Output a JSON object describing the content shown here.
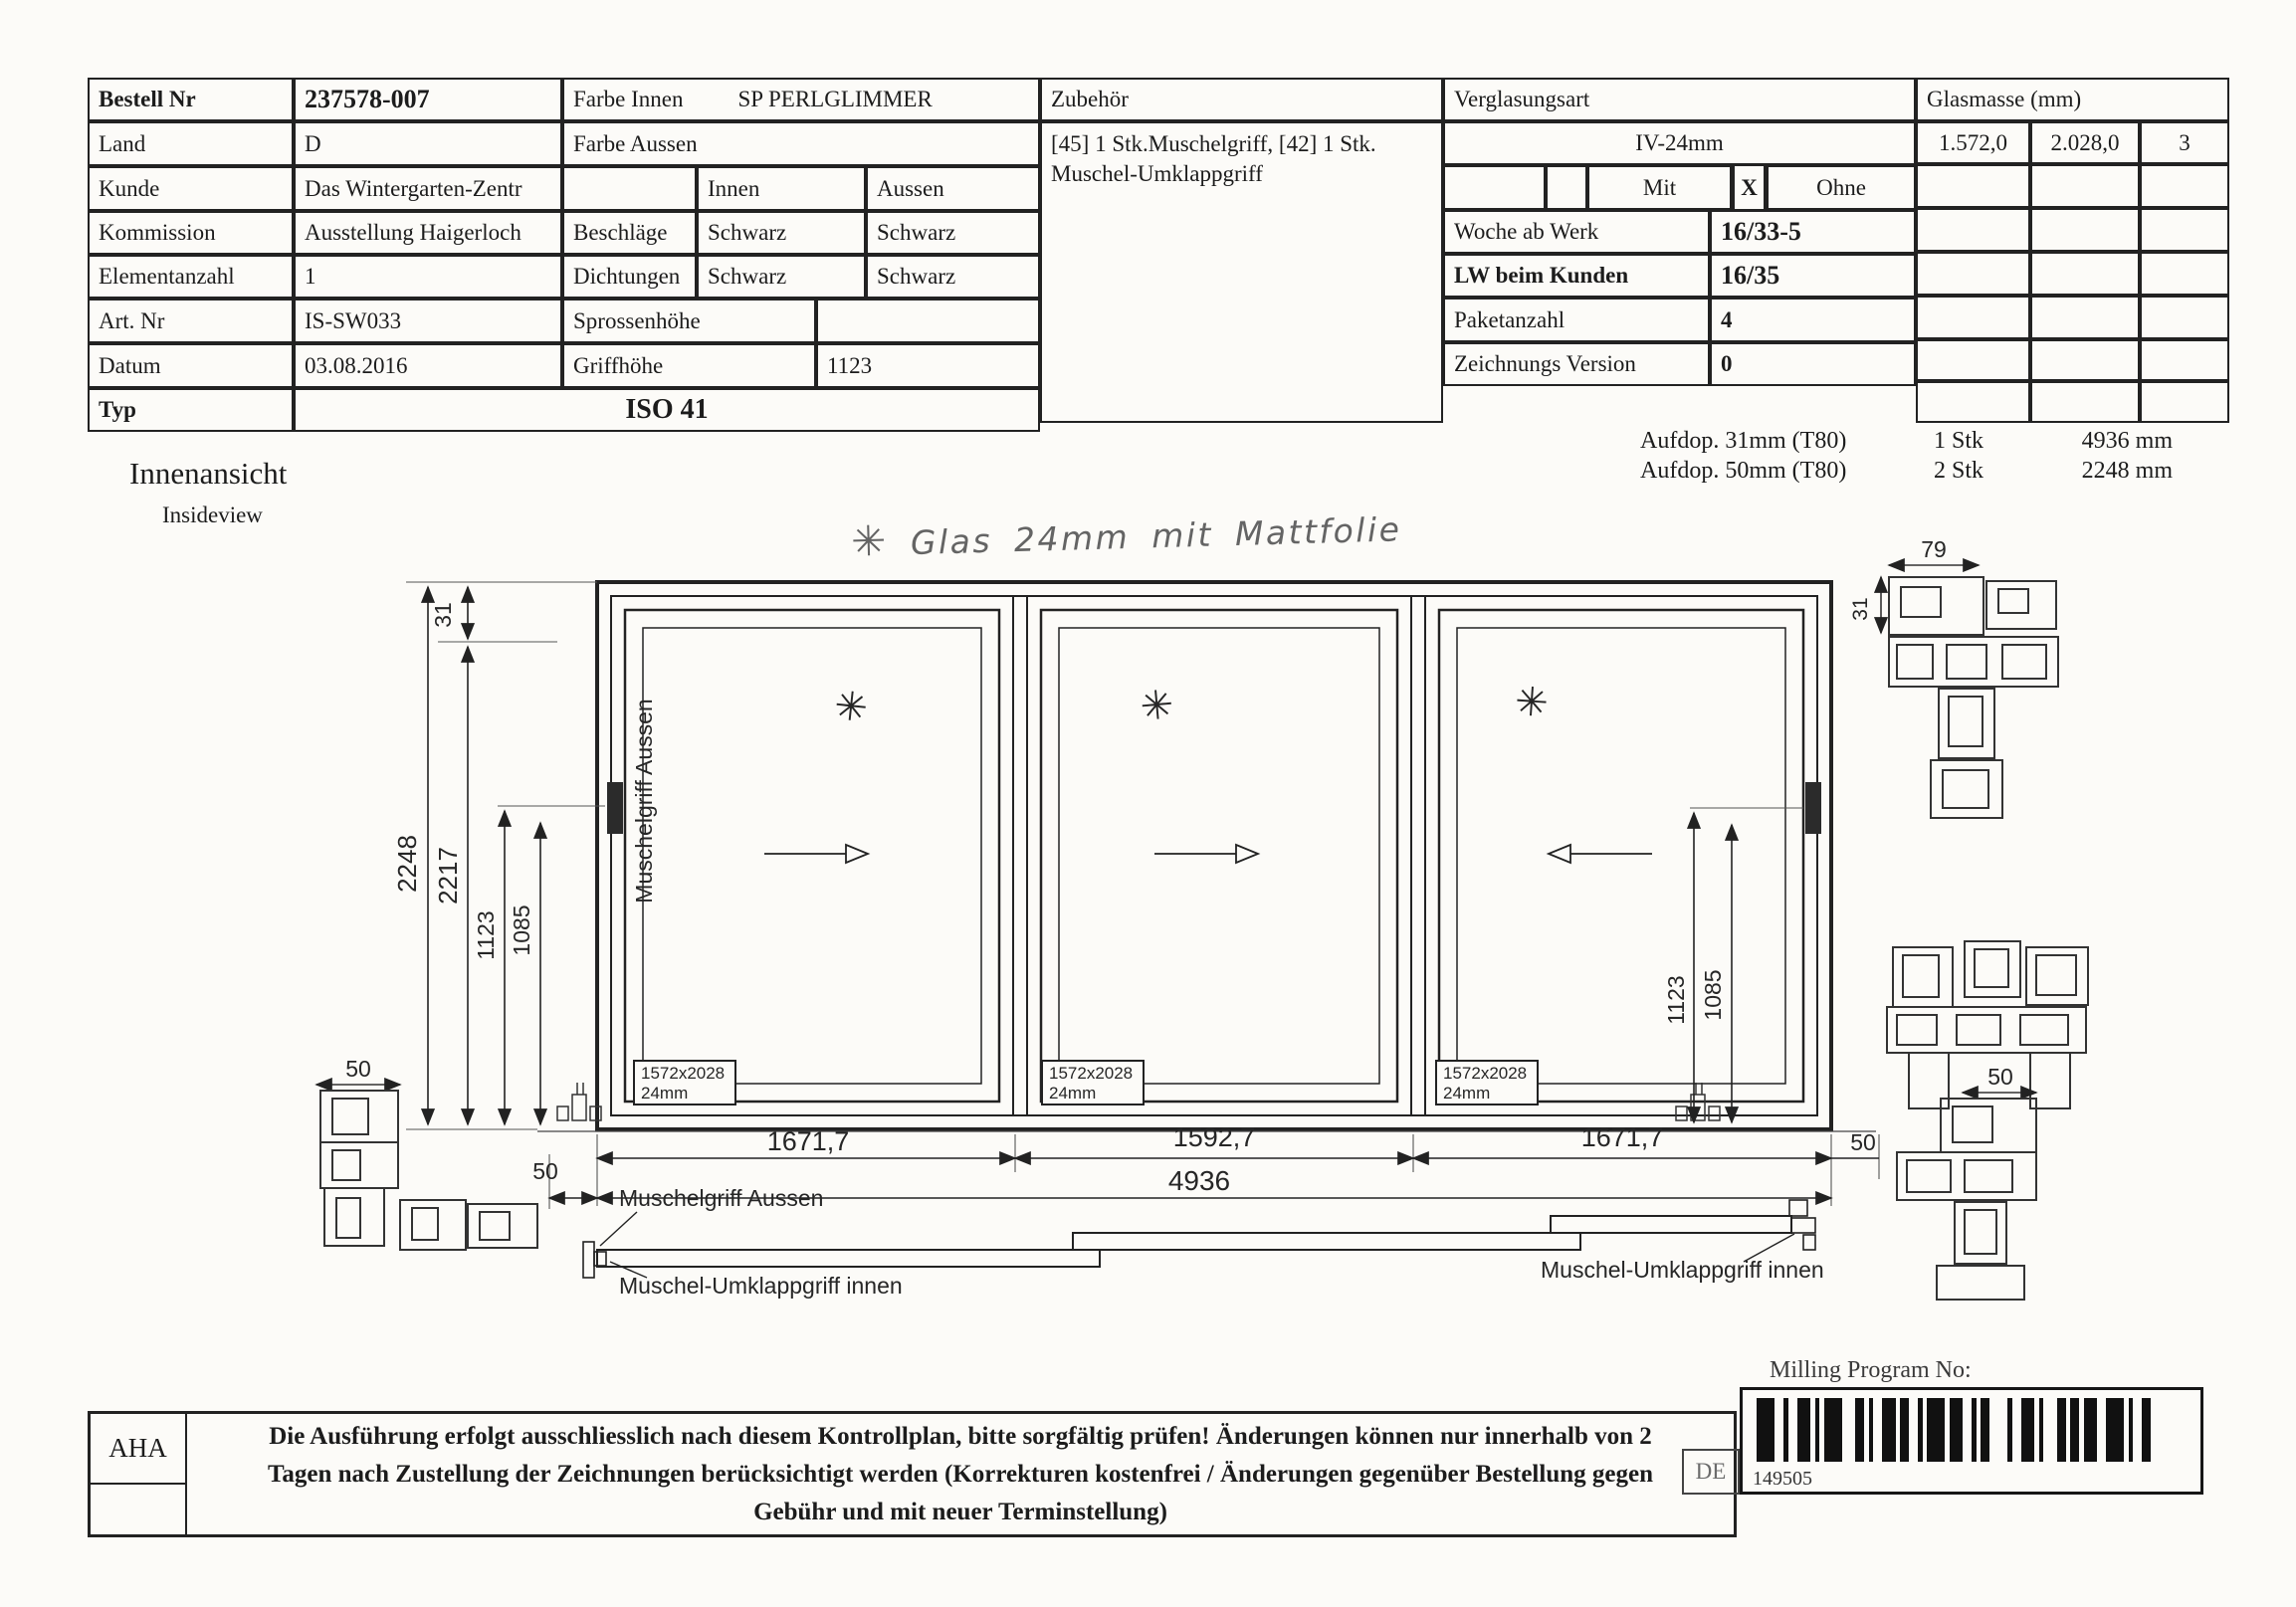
{
  "order": {
    "rows": [
      {
        "label": "Bestell Nr",
        "value": "237578-007"
      },
      {
        "label": "Land",
        "value": "D"
      },
      {
        "label": "Kunde",
        "value": "Das Wintergarten-Zentr"
      },
      {
        "label": "Kommission",
        "value": "Ausstellung Haigerloch"
      },
      {
        "label": "Elementanzahl",
        "value": "1"
      },
      {
        "label": "Art. Nr",
        "value": "IS-SW033"
      },
      {
        "label": "Datum",
        "value": "03.08.2016"
      },
      {
        "label": "Typ",
        "value": "ISO 41"
      }
    ]
  },
  "colors": {
    "farbe_innen": "Farbe Innen",
    "farbe_innen_value": "SP PERLGLIMMER",
    "farbe_aussen": "Farbe Aussen",
    "innen": "Innen",
    "aussen": "Aussen",
    "beschlaege": "Beschläge",
    "beschlaege_innen": "Schwarz",
    "beschlaege_aussen": "Schwarz",
    "dichtungen": "Dichtungen",
    "dichtungen_innen": "Schwarz",
    "dichtungen_aussen": "Schwarz",
    "sprossenhoehe": "Sprossenhöhe",
    "griffhoehe": "Griffhöhe",
    "griffhoehe_value": "1123"
  },
  "zubehoer": {
    "title": "Zubehör",
    "text": "[45] 1 Stk.Muschelgriff, [42] 1 Stk. Muschel-Umklappgriff"
  },
  "verglasung": {
    "title": "Verglasungsart",
    "art": "IV-24mm",
    "mit": "Mit",
    "mark": "X",
    "ohne": "Ohne",
    "rows": [
      {
        "label": "Woche ab Werk",
        "value": "16/33-5"
      },
      {
        "label": "LW beim Kunden",
        "value": "16/35"
      },
      {
        "label": "Paketanzahl",
        "value": "4"
      },
      {
        "label": "Zeichnungs Version",
        "value": "0"
      }
    ]
  },
  "glasmasse": {
    "title": "Glasmasse (mm)",
    "col1": "1.572,0",
    "col2": "2.028,0",
    "col3": "3"
  },
  "aufdop": {
    "rows": [
      {
        "name": "Aufdop.  31mm (T80)",
        "qty": "1 Stk",
        "length": "4936 mm"
      },
      {
        "name": "Aufdop.  50mm (T80)",
        "qty": "2 Stk",
        "length": "2248 mm"
      }
    ]
  },
  "view": {
    "title": "Innenansicht",
    "subtitle": "Insideview"
  },
  "note": {
    "star": "✳",
    "text": "Glas 24mm mit Mattfolie"
  },
  "drawing": {
    "dims": {
      "v31": "31",
      "v2248": "2248",
      "v2217": "2217",
      "v1123": "1123",
      "v1085": "1085",
      "w1": "1671,7",
      "w2": "1592,7",
      "w3": "1671,7",
      "total": "4936",
      "d50": "50",
      "d79": "79"
    },
    "glass_size": "1572x2028",
    "glass_thickness": "24mm",
    "handle_vertical": "Muschelgriff Aussen",
    "label_shell_outside": "Muschelgriff Aussen",
    "label_flip_inside_left": "Muschel-Umklappgriff innen",
    "label_flip_inside_right": "Muschel-Umklappgriff innen"
  },
  "footer": {
    "aha": "AHA",
    "notice1": "Die Ausführung erfolgt ausschliesslich nach diesem Kontrollplan, bitte sorgfältig prüfen! Änderungen können nur innerhalb von 2",
    "notice2": "Tagen nach Zustellung der Zeichnungen berücksichtigt werden (Korrekturen kostenfrei / Änderungen gegenüber Bestellung gegen",
    "notice3": "Gebühr und mit neuer Terminstellung)",
    "milling": "Milling Program No:",
    "country": "DE",
    "barcode_number": "149505"
  }
}
